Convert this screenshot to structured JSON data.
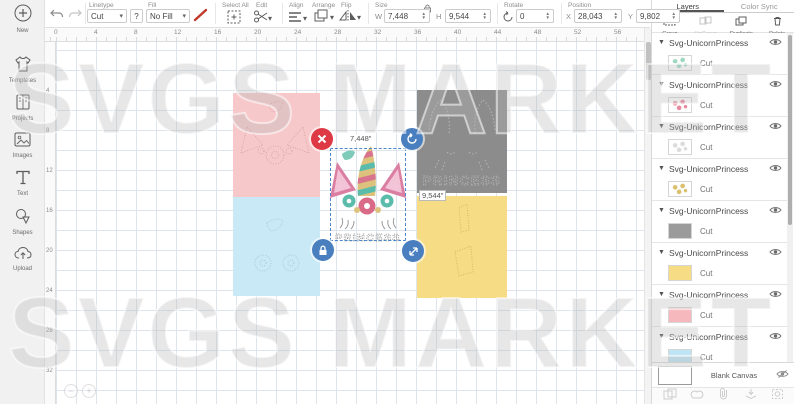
{
  "watermark": {
    "text": "SVGS MARKET"
  },
  "sidebar": {
    "items": [
      {
        "label": "New"
      },
      {
        "label": "Templates"
      },
      {
        "label": "Projects"
      },
      {
        "label": "Images"
      },
      {
        "label": "Text"
      },
      {
        "label": "Shapes"
      },
      {
        "label": "Upload"
      }
    ]
  },
  "toolbar": {
    "linetype": {
      "label": "Linetype",
      "value": "Cut",
      "help": "?"
    },
    "fill": {
      "label": "Fill",
      "value": "No Fill"
    },
    "select_all": "Select All",
    "edit": "Edit",
    "align": "Align",
    "arrange": "Arrange",
    "flip": "Flip",
    "size": {
      "label": "Size",
      "w_label": "W",
      "w": "7,448",
      "h_label": "H",
      "h": "9,544"
    },
    "rotate": {
      "label": "Rotate",
      "value": "0"
    },
    "position": {
      "label": "Position",
      "x_label": "X",
      "x": "28,043",
      "y_label": "Y",
      "y": "9,802"
    }
  },
  "canvas": {
    "h_ruler": [
      "0",
      "4",
      "8",
      "12",
      "16",
      "20",
      "24",
      "28",
      "32",
      "36",
      "40",
      "44",
      "48",
      "52",
      "56"
    ],
    "v_ruler": [
      "4",
      "8",
      "12",
      "16",
      "20",
      "24",
      "28",
      "32"
    ],
    "selection": {
      "width_label": "7,448\"",
      "height_label": "9,544\""
    },
    "design_text": "PRINCESS"
  },
  "layers_panel": {
    "tabs": [
      "Layers",
      "Color Sync"
    ],
    "actions": [
      "Group",
      "UnGroup",
      "Duplicate",
      "Delete"
    ],
    "layer_name": "Svg-UnicornPrincess",
    "layers": [
      {
        "name": "Svg-UnicornPrincess",
        "operation": "Cut",
        "swatch_kind": "pattern",
        "swatch_color": "#9fd8c0"
      },
      {
        "name": "Svg-UnicornPrincess",
        "operation": "Cut",
        "swatch_kind": "pattern",
        "swatch_color": "#e9899f"
      },
      {
        "name": "Svg-UnicornPrincess",
        "operation": "Cut",
        "swatch_kind": "pattern",
        "swatch_color": "#dcdcdc"
      },
      {
        "name": "Svg-UnicornPrincess",
        "operation": "Cut",
        "swatch_kind": "pattern",
        "swatch_color": "#d9bf6e"
      },
      {
        "name": "Svg-UnicornPrincess",
        "operation": "Cut",
        "swatch_kind": "solid",
        "swatch_color": "#9b9b9b"
      },
      {
        "name": "Svg-UnicornPrincess",
        "operation": "Cut",
        "swatch_kind": "solid",
        "swatch_color": "#f6dc85"
      },
      {
        "name": "Svg-UnicornPrincess",
        "operation": "Cut",
        "swatch_kind": "solid",
        "swatch_color": "#f6b8bc"
      },
      {
        "name": "Svg-UnicornPrincess",
        "operation": "Cut",
        "swatch_kind": "solid",
        "swatch_color": "#bfe4f5"
      }
    ],
    "canvas_row": {
      "label": "Blank Canvas"
    },
    "bottom_icons": [
      "slice",
      "weld",
      "attach",
      "flatten",
      "contour"
    ]
  },
  "colors": {
    "mat_pink": "#f7c8ca",
    "mat_cyan": "#c8e9f5",
    "mat_gray": "#8c8c8c",
    "mat_yellow": "#f6dc85",
    "selection_blue": "#4a86c8",
    "handle_blue": "#4a7fbf",
    "handle_red": "#dd3a45",
    "horn_gold": "#dcc27c",
    "accent_pink": "#d9748f",
    "accent_teal": "#5cbcab"
  }
}
